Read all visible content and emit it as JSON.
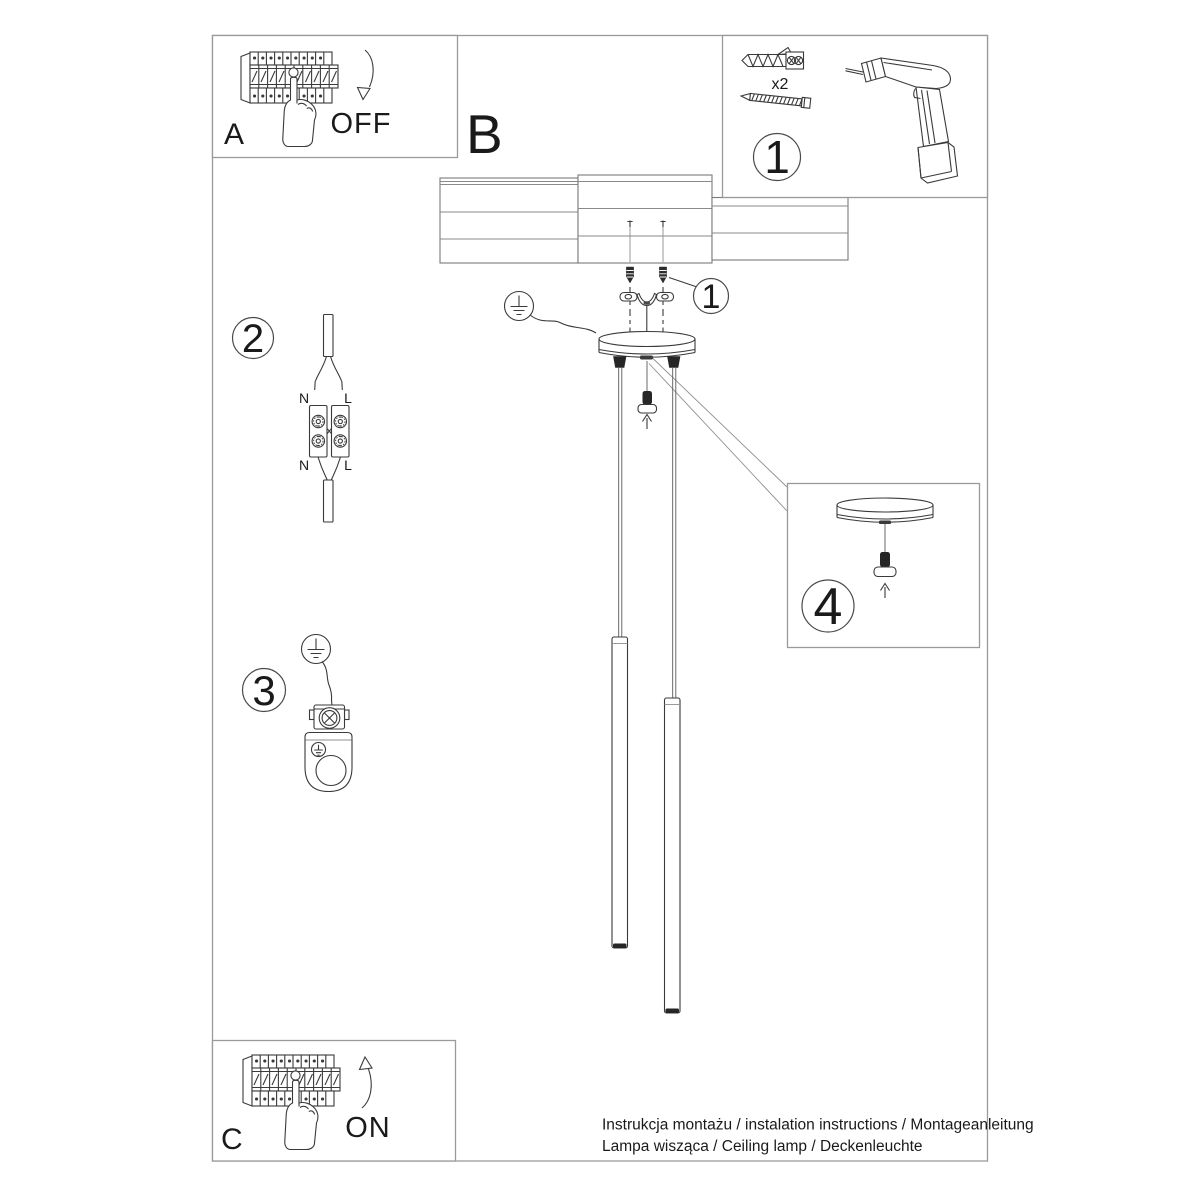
{
  "document": {
    "sections": {
      "a": "A",
      "b": "B",
      "c": "C",
      "off": "OFF",
      "on": "ON"
    },
    "badges": {
      "tools": "1",
      "bracket_callout": "1",
      "step2": "2",
      "step3": "3",
      "step4": "4"
    },
    "parts": {
      "anchor_qty": "x2"
    },
    "wiring": {
      "n_top": "N",
      "l_top": "L",
      "n_bottom": "N",
      "l_bottom": "L"
    },
    "footer": {
      "line1": "Instrukcja montażu / instalation instructions / Montageanleitung",
      "line2": "Lampa wisząca / Ceiling lamp / Deckenleuchte"
    },
    "colors": {
      "ink": "#3a3a3a",
      "frame_border": "#9a9a9a",
      "paper": "#ffffff"
    }
  }
}
